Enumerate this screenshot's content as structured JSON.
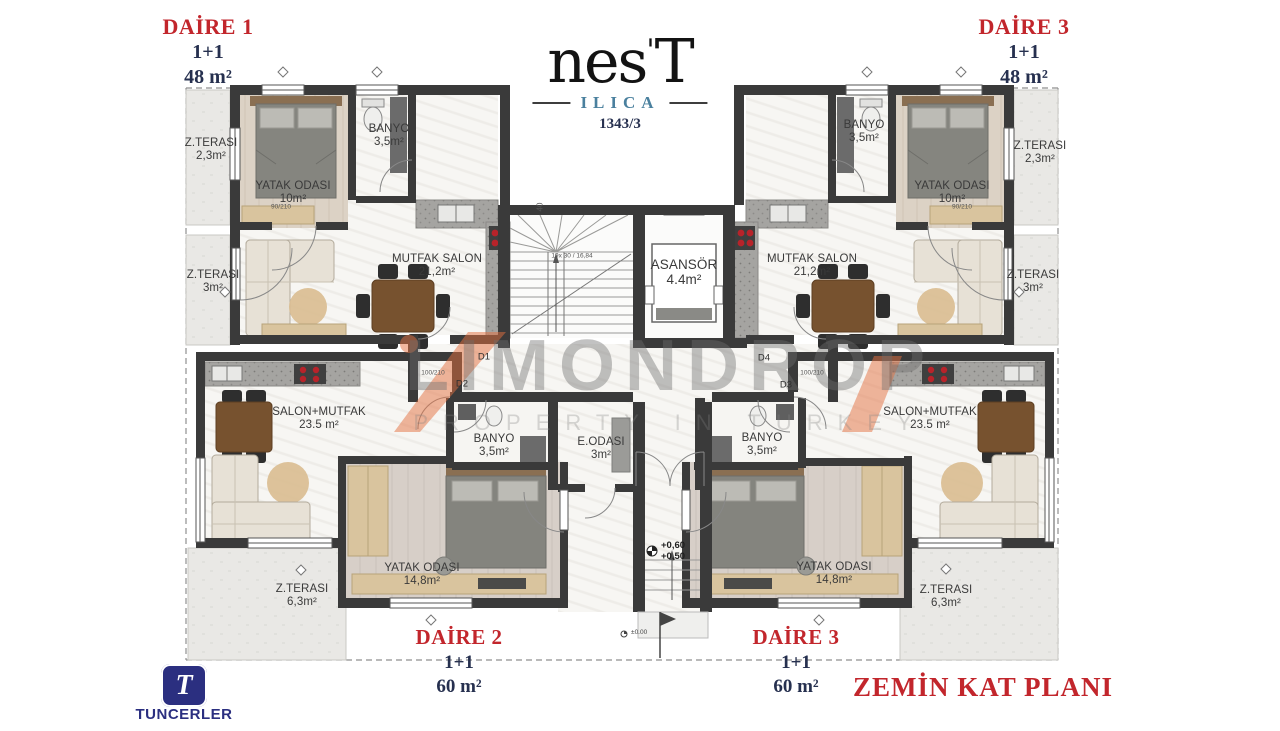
{
  "branding": {
    "logo_text": "nes",
    "logo_mark": "'",
    "logo_tail": "T",
    "logo_location": "ILICA",
    "logo_number": "1343/3",
    "builder": "TUNCERLER",
    "builder_initial": "T"
  },
  "watermark": {
    "line1": "LIMONDROP",
    "line2": "PROPERTY IN TURKEY"
  },
  "plan_title": "ZEMİN KAT PLANI",
  "apartments": {
    "daire1": {
      "title": "DAİRE 1",
      "layout": "1+1",
      "area": "48 m²"
    },
    "daire3_upper": {
      "title": "DAİRE 3",
      "layout": "1+1",
      "area": "48 m²"
    },
    "daire2": {
      "title": "DAİRE 2",
      "layout": "1+1",
      "area": "60 m²"
    },
    "daire3_lower": {
      "title": "DAİRE 3",
      "layout": "1+1",
      "area": "60 m²"
    }
  },
  "rooms": {
    "terrace_upper_left": {
      "name": "Z.TERASI",
      "area": "2,3m²"
    },
    "bedroom_upper_left": {
      "name": "YATAK ODASI",
      "area": "10m²"
    },
    "bath_upper_left": {
      "name": "BANYO",
      "area": "3,5m²"
    },
    "living_upper_left": {
      "name": "MUTFAK SALON",
      "area": "21,2m²"
    },
    "terrace_mid_left": {
      "name": "Z.TERASI",
      "area": "3m²"
    },
    "elevator": {
      "name": "ASANSÖR",
      "area": "4.4m²"
    },
    "bath_upper_right": {
      "name": "BANYO",
      "area": "3,5m²"
    },
    "bedroom_upper_right": {
      "name": "YATAK ODASI",
      "area": "10m²"
    },
    "terrace_upper_right": {
      "name": "Z.TERASI",
      "area": "2,3m²"
    },
    "living_upper_right": {
      "name": "MUTFAK SALON",
      "area": "21,2m²"
    },
    "terrace_mid_right": {
      "name": "Z.TERASI",
      "area": "3m²"
    },
    "living_lower_left": {
      "name": "SALON+MUTFAK",
      "area": "23.5 m²"
    },
    "bath_lower_left": {
      "name": "BANYO",
      "area": "3,5m²"
    },
    "entry_room": {
      "name": "E.ODASI",
      "area": "3m²"
    },
    "bath_lower_right": {
      "name": "BANYO",
      "area": "3,5m²"
    },
    "living_lower_right": {
      "name": "SALON+MUTFAK",
      "area": "23.5 m²"
    },
    "bedroom_lower_left": {
      "name": "YATAK ODASI",
      "area": "14,8m²"
    },
    "bedroom_lower_right": {
      "name": "YATAK ODASI",
      "area": "14,8m²"
    },
    "terrace_lower_left": {
      "name": "Z.TERASI",
      "area": "6,3m²"
    },
    "terrace_lower_right": {
      "name": "Z.TERASI",
      "area": "6,3m²"
    }
  },
  "doors": {
    "d1": "D1",
    "d2": "D2",
    "d3": "D3",
    "d4": "D4"
  },
  "levels": {
    "entry_upper": "+0,60",
    "entry_lower": "+0,50",
    "ground": "±0.00"
  },
  "stairs": {
    "note": "19x 30 / 16,84"
  },
  "dims": {
    "door_main": "100/210",
    "door_room": "90/210",
    "wall_40": "40"
  },
  "colors": {
    "red": "#c2262c",
    "navy": "#26304f",
    "teal": "#4a809e",
    "wall": "#3a3a3a",
    "orange": "#e4703f",
    "builder_navy": "#2b2f80"
  }
}
